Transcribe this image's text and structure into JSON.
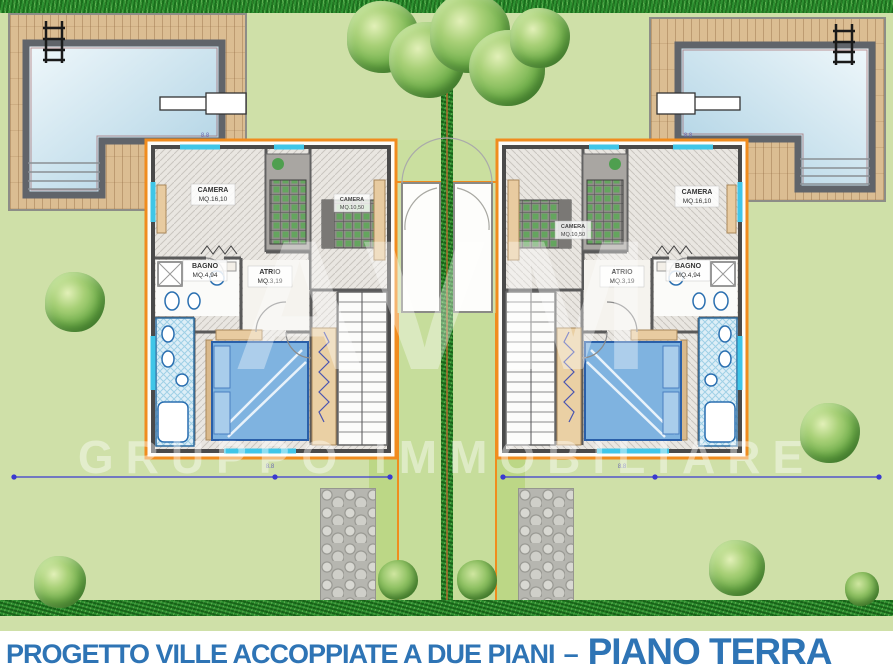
{
  "caption": {
    "part1": "PROGETTO VILLE ACCOPPIATE A DUE PIANI",
    "separator": "–",
    "part2": "PIANO TERRA"
  },
  "watermark": {
    "logo": "AVM",
    "text": "GRUPPO IMMOBILIARE"
  },
  "plan": {
    "rooms": {
      "camera1": {
        "name": "CAMERA",
        "area": "MQ.16,10"
      },
      "camera2": {
        "name": "CAMERA",
        "area": "MQ.10,50"
      },
      "bagno": {
        "name": "BAGNO",
        "area": "MQ.4,94"
      },
      "atrio": {
        "name": "ATRIO",
        "area": "MQ.3,19"
      }
    },
    "dimensions": {
      "width_label": "8.8"
    }
  },
  "colors": {
    "caption_blue": "#2e74b5",
    "plan_border_orange": "#f08c1e",
    "water_blue": "#bfdcea",
    "garden_green": "#cfe0a8",
    "hedge_green": "#2f9232",
    "bed_blue": "#7fb3e0"
  }
}
